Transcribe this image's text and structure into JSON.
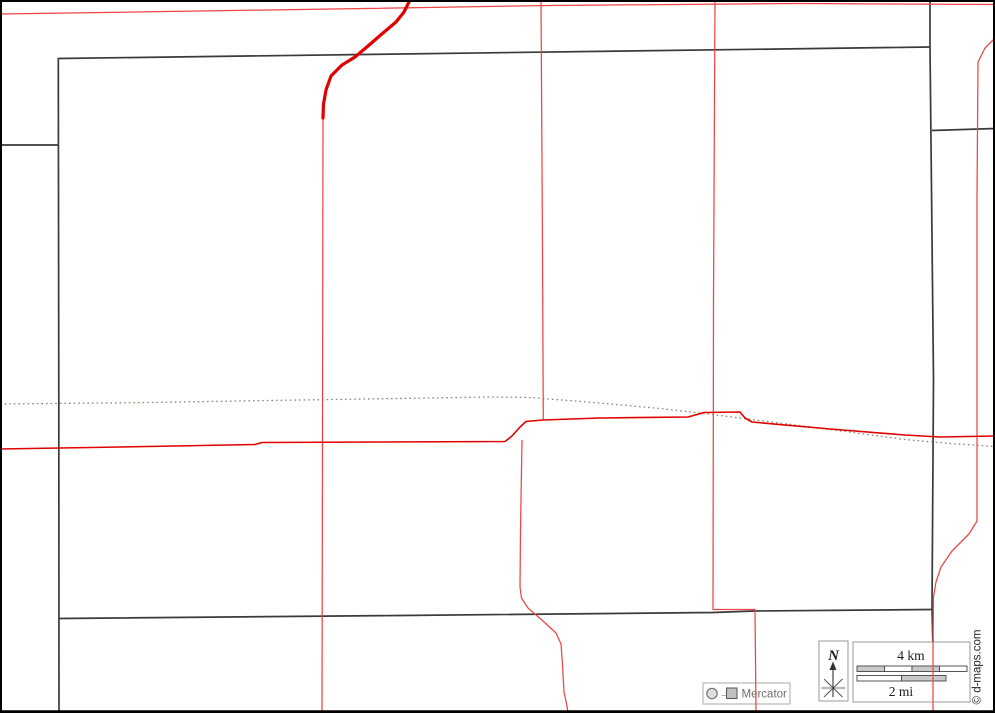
{
  "legend": {
    "north_label": "N",
    "scale_km_label": "4 km",
    "scale_mi_label": "2 mi",
    "projection_label": "Mercator",
    "projection_arrow": "→",
    "copyright": "© d-maps.com"
  },
  "colors": {
    "background": "#ffffff",
    "frame": "#000000",
    "boundary": "#3a3a3a",
    "dotted_boundary": "#93836f",
    "road_major": "#e10000",
    "road_minor": "#ee4444",
    "box_border": "#999999",
    "box_border_light": "#aaaaaa",
    "box_fill": "#ffffff",
    "scale_seg_dark": "#c9c9c9",
    "scale_seg_light": "#ffffff",
    "bar_outline": "#444444",
    "text_dark": "#1a1a1a",
    "text_gray": "#6e6e6e",
    "symbol_gray": "#777777",
    "square_fill": "#c0c0c0"
  },
  "map_geometry": {
    "boundaries": [
      [
        [
          58,
          58.5
        ],
        [
          930,
          47
        ]
      ],
      [
        [
          58.3,
          58
        ],
        [
          58.8,
          400
        ],
        [
          59,
          713
        ]
      ],
      [
        [
          59,
          618.5
        ],
        [
          400,
          615.5
        ],
        [
          713,
          612.5
        ],
        [
          755,
          611
        ],
        [
          932,
          609.5
        ]
      ],
      [
        [
          930,
          0
        ],
        [
          930,
          47
        ]
      ],
      [
        [
          930,
          47
        ],
        [
          933.5,
          380
        ],
        [
          932,
          609.5
        ]
      ],
      [
        [
          932,
          609.5
        ],
        [
          933,
          648
        ]
      ],
      [
        [
          0,
          145
        ],
        [
          58,
          145
        ]
      ],
      [
        [
          932,
          130.5
        ],
        [
          995,
          128.5
        ]
      ]
    ],
    "dotted_line": [
      [
        0,
        404
      ],
      [
        150,
        402.5
      ],
      [
        300,
        400
      ],
      [
        430,
        398
      ],
      [
        490,
        397
      ],
      [
        530,
        397.5
      ],
      [
        600,
        403
      ],
      [
        660,
        408.5
      ],
      [
        708,
        414
      ],
      [
        760,
        420.5
      ],
      [
        830,
        429.5
      ],
      [
        905,
        439.5
      ],
      [
        950,
        443.5
      ],
      [
        995,
        446.5
      ]
    ],
    "roads_thick": [
      [
        [
          410,
          0
        ],
        [
          404,
          12
        ],
        [
          396,
          22
        ],
        [
          383,
          33
        ],
        [
          368,
          46
        ],
        [
          355,
          57
        ],
        [
          342,
          65
        ],
        [
          331,
          76
        ],
        [
          326,
          90
        ],
        [
          323.5,
          104
        ],
        [
          323,
          118
        ]
      ]
    ],
    "roads_main": [
      [
        [
          0,
          449
        ],
        [
          120,
          447
        ],
        [
          255,
          444.5
        ],
        [
          262,
          442.5
        ],
        [
          505,
          441.5
        ],
        [
          512,
          436
        ],
        [
          520,
          427
        ],
        [
          526,
          421.5
        ],
        [
          543,
          420
        ],
        [
          600,
          418
        ],
        [
          688,
          417
        ],
        [
          697,
          414.5
        ],
        [
          704,
          412.5
        ],
        [
          740,
          412
        ],
        [
          745,
          418
        ],
        [
          752,
          422
        ],
        [
          830,
          429
        ],
        [
          905,
          435
        ],
        [
          940,
          437
        ],
        [
          995,
          436
        ]
      ]
    ],
    "roads_minor": [
      [
        [
          323,
          118
        ],
        [
          322.5,
          445
        ],
        [
          322,
          713
        ]
      ],
      [
        [
          0,
          14
        ],
        [
          300,
          9.5
        ],
        [
          550,
          5.5
        ],
        [
          800,
          3.5
        ],
        [
          995,
          4.5
        ]
      ],
      [
        [
          541,
          0
        ],
        [
          542.5,
          250
        ],
        [
          543.3,
          420
        ]
      ],
      [
        [
          715,
          0
        ],
        [
          713.5,
          300
        ],
        [
          713,
          609.5
        ],
        [
          755,
          609.5
        ],
        [
          755.5,
          660
        ],
        [
          756,
          713
        ]
      ],
      [
        [
          995,
          38
        ],
        [
          985,
          48
        ],
        [
          978,
          62
        ],
        [
          977,
          200
        ],
        [
          977,
          521
        ],
        [
          969,
          534
        ],
        [
          952,
          551
        ],
        [
          941,
          567
        ],
        [
          936,
          582
        ],
        [
          933.5,
          597
        ],
        [
          933,
          650
        ],
        [
          933,
          713
        ]
      ],
      [
        [
          522,
          440
        ],
        [
          520.5,
          530
        ],
        [
          520,
          587
        ],
        [
          521.5,
          598
        ],
        [
          528,
          608
        ],
        [
          543,
          621
        ],
        [
          556,
          633
        ],
        [
          561,
          644
        ],
        [
          562.5,
          665
        ],
        [
          564,
          692
        ],
        [
          567,
          706
        ],
        [
          568,
          713
        ]
      ]
    ],
    "scale_bars": {
      "km": {
        "x": 857,
        "y": 666,
        "w": 110,
        "h": 5.5,
        "segments": [
          "dark",
          "light",
          "dark",
          "light"
        ]
      },
      "mi": {
        "x": 857,
        "y": 675.5,
        "w": 89,
        "h": 5.5,
        "segments": [
          "light",
          "dark"
        ]
      }
    }
  }
}
